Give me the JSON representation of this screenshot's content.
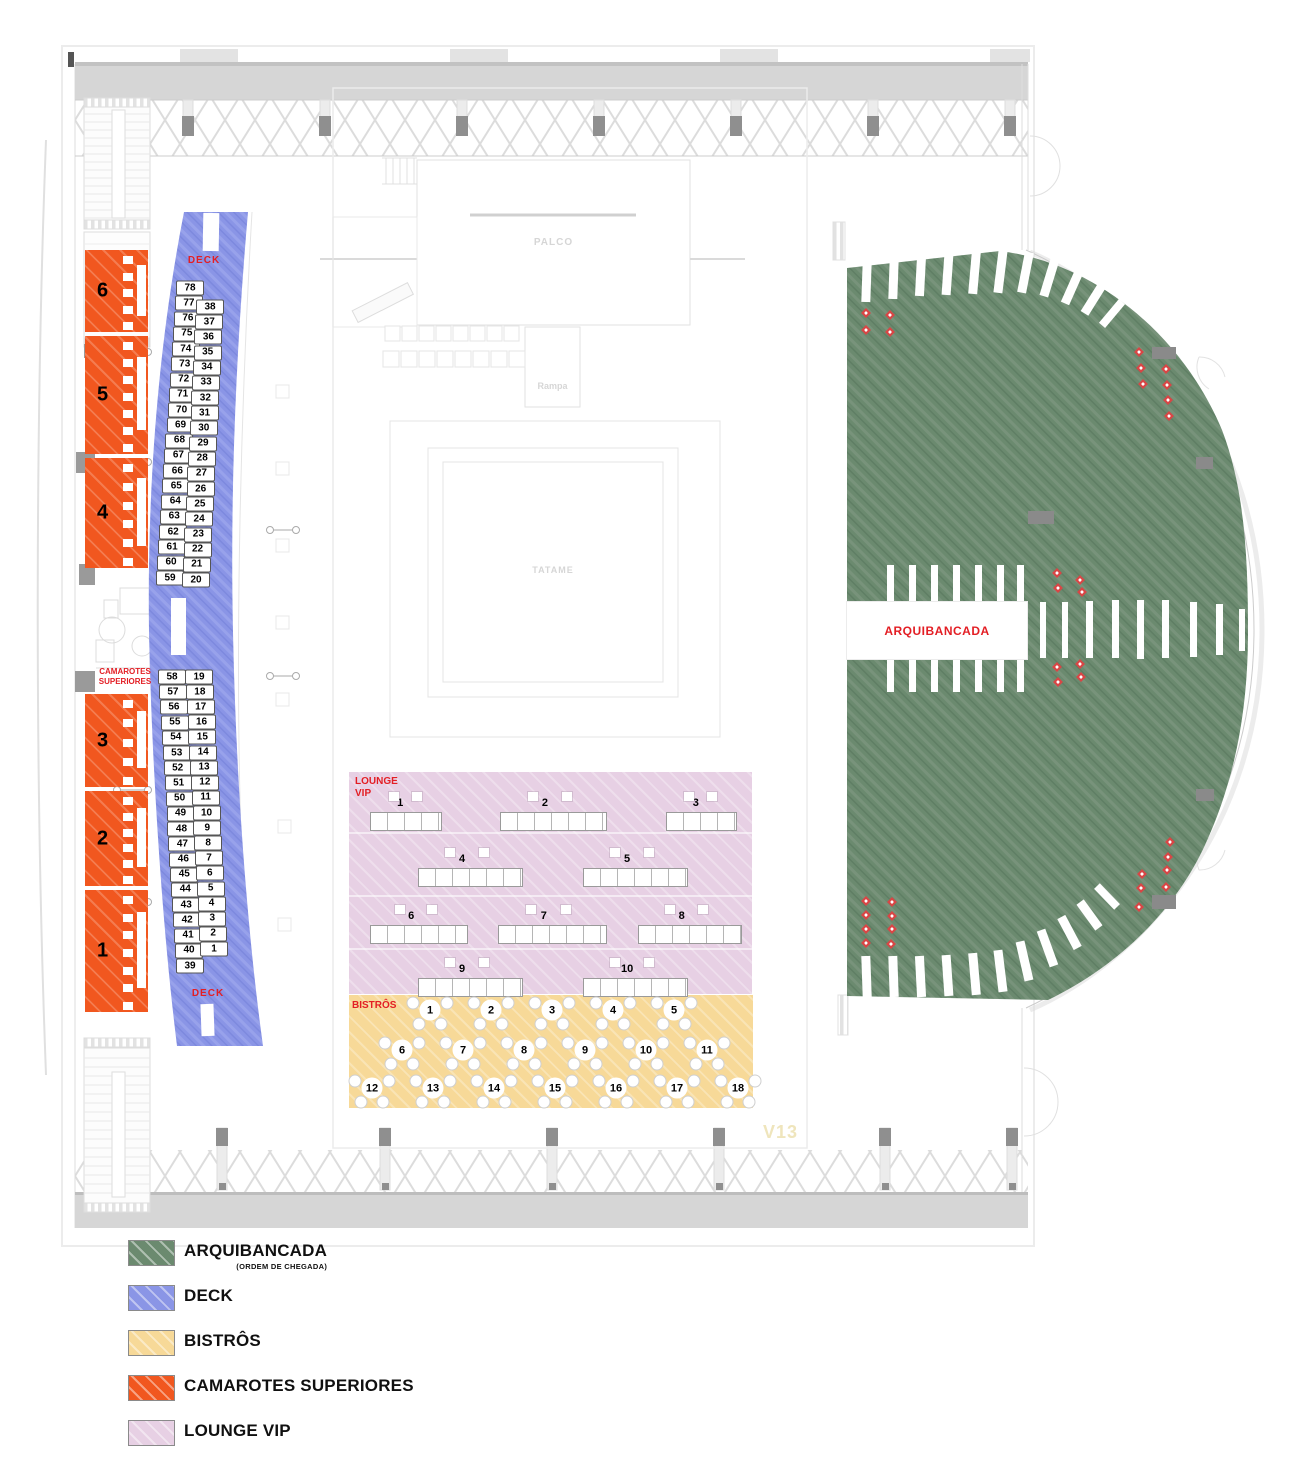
{
  "colors": {
    "arquibancada": "#6B8A6F",
    "deck": "#8A95E6",
    "bistros": "#F7D998",
    "camarotes": "#F1571F",
    "lounge": "#E7D0E4",
    "label_red": "#E31E24",
    "marker_red": "#D94545",
    "watermark_yellow": "#EFE5BC"
  },
  "stage_labels": {
    "palco": "PALCO",
    "rampa": "Rampa",
    "tatame": "TATAME"
  },
  "watermark": "V13",
  "arquibancada": {
    "label": "ARQUIBANCADA",
    "marker_icon": "accessible-seat-marker"
  },
  "deck": {
    "label": "DECK",
    "columns": [
      {
        "id": "left-upper",
        "x0": 190,
        "y0": 288,
        "x1": 170,
        "y1": 578,
        "numbers": [
          78,
          77,
          76,
          75,
          74,
          73,
          72,
          71,
          70,
          69,
          68,
          67,
          66,
          65,
          64,
          63,
          62,
          61,
          60,
          59
        ]
      },
      {
        "id": "right-upper",
        "x0": 210,
        "y0": 307,
        "x1": 196,
        "y1": 580,
        "numbers": [
          38,
          37,
          36,
          35,
          34,
          33,
          32,
          31,
          30,
          29,
          28,
          27,
          26,
          25,
          24,
          23,
          22,
          21,
          20
        ]
      },
      {
        "id": "left-lower",
        "x0": 172,
        "y0": 677,
        "x1": 190,
        "y1": 966,
        "numbers": [
          58,
          57,
          56,
          55,
          54,
          53,
          52,
          51,
          50,
          49,
          48,
          47,
          46,
          45,
          44,
          43,
          42,
          41,
          40,
          39
        ]
      },
      {
        "id": "right-lower",
        "x0": 199,
        "y0": 677,
        "x1": 214,
        "y1": 949,
        "numbers": [
          19,
          18,
          17,
          16,
          15,
          14,
          13,
          12,
          11,
          10,
          9,
          8,
          7,
          6,
          5,
          4,
          3,
          2,
          1
        ]
      }
    ]
  },
  "camarotes": {
    "label_line1": "CAMAROTES",
    "label_line2": "SUPERIORES",
    "boxes": [
      {
        "n": "6",
        "y": 250,
        "h": 82
      },
      {
        "n": "5",
        "y": 336,
        "h": 118
      },
      {
        "n": "4",
        "y": 458,
        "h": 110
      },
      {
        "n": "3",
        "y": 694,
        "h": 93
      },
      {
        "n": "2",
        "y": 791,
        "h": 95
      },
      {
        "n": "1",
        "y": 890,
        "h": 122
      }
    ]
  },
  "lounge": {
    "label_line1": "LOUNGE",
    "label_line2": "VIP",
    "tables": [
      {
        "n": "1",
        "x": 370,
        "y": 812,
        "w": 72
      },
      {
        "n": "2",
        "x": 500,
        "y": 812,
        "w": 107
      },
      {
        "n": "3",
        "x": 666,
        "y": 812,
        "w": 71
      },
      {
        "n": "4",
        "x": 418,
        "y": 868,
        "w": 105
      },
      {
        "n": "5",
        "x": 583,
        "y": 868,
        "w": 105
      },
      {
        "n": "6",
        "x": 370,
        "y": 925,
        "w": 98
      },
      {
        "n": "7",
        "x": 498,
        "y": 925,
        "w": 109
      },
      {
        "n": "8",
        "x": 638,
        "y": 925,
        "w": 104
      },
      {
        "n": "9",
        "x": 418,
        "y": 978,
        "w": 105
      },
      {
        "n": "10",
        "x": 583,
        "y": 978,
        "w": 105
      }
    ]
  },
  "bistros": {
    "label": "BISTRÔS",
    "tables": [
      {
        "n": "1",
        "x": 430,
        "y": 1012
      },
      {
        "n": "2",
        "x": 491,
        "y": 1012
      },
      {
        "n": "3",
        "x": 552,
        "y": 1012
      },
      {
        "n": "4",
        "x": 613,
        "y": 1012
      },
      {
        "n": "5",
        "x": 674,
        "y": 1012
      },
      {
        "n": "6",
        "x": 402,
        "y": 1052
      },
      {
        "n": "7",
        "x": 463,
        "y": 1052
      },
      {
        "n": "8",
        "x": 524,
        "y": 1052
      },
      {
        "n": "9",
        "x": 585,
        "y": 1052
      },
      {
        "n": "10",
        "x": 646,
        "y": 1052
      },
      {
        "n": "11",
        "x": 707,
        "y": 1052
      },
      {
        "n": "12",
        "x": 372,
        "y": 1090
      },
      {
        "n": "13",
        "x": 433,
        "y": 1090
      },
      {
        "n": "14",
        "x": 494,
        "y": 1090
      },
      {
        "n": "15",
        "x": 555,
        "y": 1090
      },
      {
        "n": "16",
        "x": 616,
        "y": 1090
      },
      {
        "n": "17",
        "x": 677,
        "y": 1090
      },
      {
        "n": "18",
        "x": 738,
        "y": 1090
      }
    ]
  },
  "legend": {
    "items": [
      {
        "label": "ARQUIBANCADA",
        "sublabel": "(ORDEM DE CHEGADA)",
        "key": "arquibancada"
      },
      {
        "label": "DECK",
        "sublabel": "",
        "key": "deck"
      },
      {
        "label": "BISTRÔS",
        "sublabel": "",
        "key": "bistros"
      },
      {
        "label": "CAMAROTES SUPERIORES",
        "sublabel": "",
        "key": "camarotes"
      },
      {
        "label": "LOUNGE VIP",
        "sublabel": "",
        "key": "lounge"
      }
    ]
  }
}
